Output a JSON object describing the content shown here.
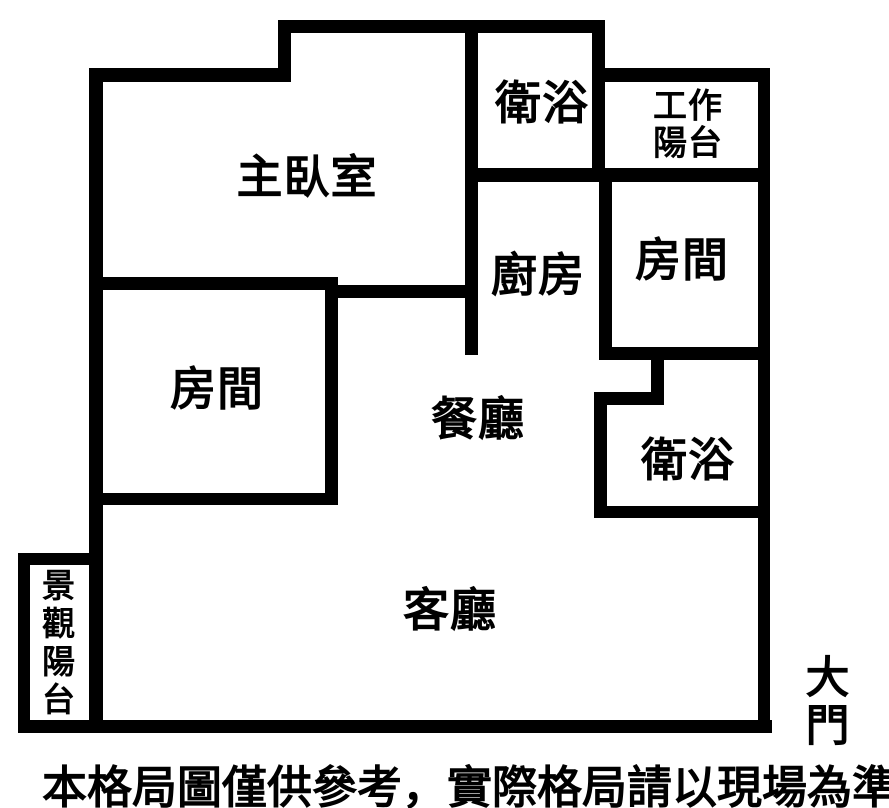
{
  "title": "apartment-floor-plan",
  "colors": {
    "wall": "#000000",
    "background": "#ffffff",
    "text": "#000000"
  },
  "labels": [
    {
      "id": "master-bedroom",
      "text": "主臥室",
      "x": 307,
      "y": 178,
      "size": 46
    },
    {
      "id": "bathroom-top",
      "text": "衛浴",
      "x": 542,
      "y": 104,
      "size": 46
    },
    {
      "id": "work-balcony",
      "text": "工作\n陽台",
      "x": 688,
      "y": 125,
      "size": 34
    },
    {
      "id": "kitchen",
      "text": "廚房",
      "x": 538,
      "y": 276,
      "size": 46
    },
    {
      "id": "room-right",
      "text": "房間",
      "x": 682,
      "y": 261,
      "size": 46
    },
    {
      "id": "room-left",
      "text": "房間",
      "x": 217,
      "y": 390,
      "size": 46
    },
    {
      "id": "dining-room",
      "text": "餐廳",
      "x": 478,
      "y": 420,
      "size": 46
    },
    {
      "id": "bathroom-right",
      "text": "衛浴",
      "x": 688,
      "y": 461,
      "size": 46
    },
    {
      "id": "living-room",
      "text": "客廳",
      "x": 450,
      "y": 611,
      "size": 46
    },
    {
      "id": "view-balcony",
      "text": "景觀陽台",
      "x": 56,
      "y": 644,
      "size": 33,
      "vertical": true
    },
    {
      "id": "main-door",
      "text": "大門",
      "x": 828,
      "y": 702,
      "size": 44
    }
  ],
  "walls": [
    {
      "x": 89,
      "y": 68,
      "w": 14,
      "h": 665
    },
    {
      "x": 89,
      "y": 68,
      "w": 202,
      "h": 14
    },
    {
      "x": 278,
      "y": 20,
      "w": 13,
      "h": 62
    },
    {
      "x": 278,
      "y": 20,
      "w": 327,
      "h": 13
    },
    {
      "x": 465,
      "y": 20,
      "w": 13,
      "h": 335
    },
    {
      "x": 592,
      "y": 20,
      "w": 13,
      "h": 162
    },
    {
      "x": 592,
      "y": 68,
      "w": 178,
      "h": 14
    },
    {
      "x": 758,
      "y": 68,
      "w": 12,
      "h": 665
    },
    {
      "x": 465,
      "y": 168,
      "w": 305,
      "h": 14
    },
    {
      "x": 599,
      "y": 168,
      "w": 13,
      "h": 192
    },
    {
      "x": 89,
      "y": 277,
      "w": 249,
      "h": 13
    },
    {
      "x": 325,
      "y": 285,
      "w": 153,
      "h": 13
    },
    {
      "x": 325,
      "y": 277,
      "w": 13,
      "h": 228
    },
    {
      "x": 89,
      "y": 493,
      "w": 249,
      "h": 12
    },
    {
      "x": 599,
      "y": 347,
      "w": 171,
      "h": 13
    },
    {
      "x": 651,
      "y": 347,
      "w": 13,
      "h": 58
    },
    {
      "x": 594,
      "y": 392,
      "w": 70,
      "h": 13
    },
    {
      "x": 594,
      "y": 392,
      "w": 13,
      "h": 126
    },
    {
      "x": 594,
      "y": 506,
      "w": 176,
      "h": 12
    },
    {
      "x": 18,
      "y": 553,
      "w": 85,
      "h": 12
    },
    {
      "x": 18,
      "y": 553,
      "w": 12,
      "h": 180
    },
    {
      "x": 18,
      "y": 720,
      "w": 754,
      "h": 13
    }
  ],
  "disclaimer": {
    "text": "本格局圖僅供參考，實際格局請以現場為準"
  }
}
